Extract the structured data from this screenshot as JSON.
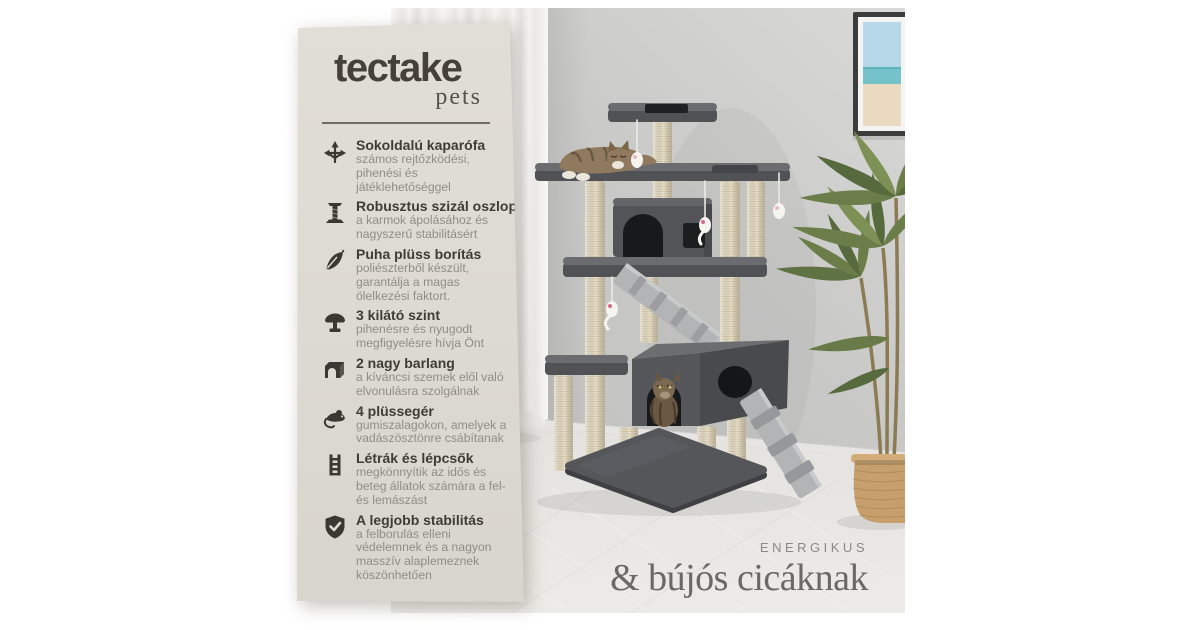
{
  "brand": {
    "wordmark": "tectake",
    "sub": "pets"
  },
  "features": [
    {
      "icon": "multidirection-arrows-icon",
      "title": "Sokoldalú kaparófa",
      "desc": "számos rejtőzködési,\npihenési és\njátéklehetőséggel"
    },
    {
      "icon": "scratching-post-icon",
      "title": "Robusztus szizál oszlopok",
      "desc": "a karmok ápolásához és\nnagyszerű stabilitásért"
    },
    {
      "icon": "feather-icon",
      "title": "Puha plüss borítás",
      "desc": "poliészterből készült,\ngarantálja a magas\nölelkezési faktort."
    },
    {
      "icon": "lookout-platform-icon",
      "title": "3 kilátó szint",
      "desc": "pihenésre és nyugodt\nmegfigyelésre hívja Önt"
    },
    {
      "icon": "cave-icon",
      "title": "2 nagy barlang",
      "desc": "a kíváncsi szemek elől való\nelvonulásra szolgálnak"
    },
    {
      "icon": "mouse-toy-icon",
      "title": "4 plüssegér",
      "desc": "gumiszalagokon, amelyek a\nvadászösztönre csábítanak"
    },
    {
      "icon": "ladder-icon",
      "title": "Létrák és lépcsők",
      "desc": "megkönnyítik az idős és\nbeteg állatok számára a fel-\nés lemászást"
    },
    {
      "icon": "shield-check-icon",
      "title": "A legjobb stabilitás",
      "desc": "a felborulás elleni\nvédelemnek és a nagyon\nmasszív alaplemeznek\nköszönhetően"
    }
  ],
  "tagline": {
    "line1": "ENERGIKUS",
    "line2": "& bújós cicáknak"
  },
  "colors": {
    "card_bg": "#dedbd3",
    "logo_ink": "#454139",
    "title_ink": "#3f3b35",
    "body_ink": "#918d86",
    "divider": "#716e66",
    "icon_ink": "#3b3732",
    "tag_small": "#8b8984",
    "tag_large": "#6b6965",
    "wall": "#c9c9c7",
    "floor": "#e8e6e2",
    "tree_gray": "#54565a",
    "sisal": "#e9e1cc",
    "palm_green": "#6b7e4a",
    "basket_tan": "#c79f6c"
  }
}
